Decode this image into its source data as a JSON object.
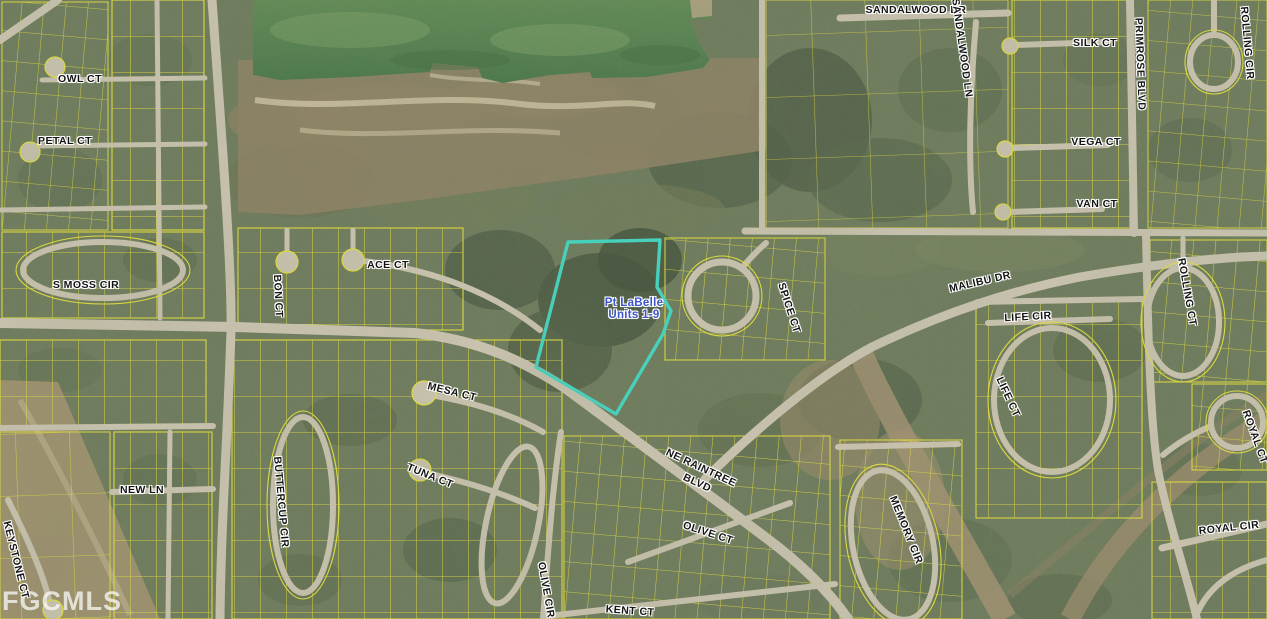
{
  "map": {
    "attribution": "FGCMLS",
    "highlight": {
      "line1": "Pt LaBelle",
      "line2": "Units 1-9",
      "outline_color": "#3fd9c6",
      "text_color": "#3d55cc"
    },
    "colors": {
      "parcel_line": "#e8e43c",
      "road": "#ccc5b2",
      "dirt": "#a29170",
      "water": "#54824f",
      "vegetation": "#5a684e"
    },
    "street_labels": [
      {
        "text": "OWL CT",
        "x": 80,
        "y": 79,
        "rot": 0
      },
      {
        "text": "PETAL CT",
        "x": 65,
        "y": 141,
        "rot": 0
      },
      {
        "text": "S MOSS CIR",
        "x": 86,
        "y": 285,
        "rot": 0
      },
      {
        "text": "SANDALWOOD DR",
        "x": 916,
        "y": 10,
        "rot": 0
      },
      {
        "text": "SANDALWOOD LN",
        "x": 962,
        "y": 48,
        "rot": 82
      },
      {
        "text": "SILK CT",
        "x": 1095,
        "y": 43,
        "rot": 0
      },
      {
        "text": "PRIMROSE BLVD",
        "x": 1140,
        "y": 64,
        "rot": 88
      },
      {
        "text": "ROLLING CIR",
        "x": 1247,
        "y": 43,
        "rot": 85
      },
      {
        "text": "VEGA CT",
        "x": 1096,
        "y": 142,
        "rot": 0
      },
      {
        "text": "VAN CT",
        "x": 1097,
        "y": 204,
        "rot": 0
      },
      {
        "text": "ACE CT",
        "x": 388,
        "y": 265,
        "rot": 0
      },
      {
        "text": "BON CT",
        "x": 278,
        "y": 296,
        "rot": 87
      },
      {
        "text": "SPICE CT",
        "x": 789,
        "y": 308,
        "rot": 72
      },
      {
        "text": "MALIBU DR",
        "x": 980,
        "y": 282,
        "rot": -13
      },
      {
        "text": "LIFE CIR",
        "x": 1028,
        "y": 317,
        "rot": -3
      },
      {
        "text": "ROLLING CT",
        "x": 1187,
        "y": 292,
        "rot": 80
      },
      {
        "text": "LIFE CT",
        "x": 1008,
        "y": 397,
        "rot": 65
      },
      {
        "text": "ROYAL CT",
        "x": 1255,
        "y": 437,
        "rot": 70
      },
      {
        "text": "MESA CT",
        "x": 452,
        "y": 392,
        "rot": 14
      },
      {
        "text": "NEW LN",
        "x": 142,
        "y": 490,
        "rot": 0
      },
      {
        "text": "KEYSTONE CT",
        "x": 16,
        "y": 560,
        "rot": 76
      },
      {
        "text": "BUTTERCUP CIR",
        "x": 281,
        "y": 502,
        "rot": 85
      },
      {
        "text": "TUNA CT",
        "x": 430,
        "y": 476,
        "rot": 22
      },
      {
        "text": "NE RAINTREE",
        "x": 701,
        "y": 468,
        "rot": 25
      },
      {
        "text": "BLVD",
        "x": 697,
        "y": 483,
        "rot": 25
      },
      {
        "text": "OLIVE CT",
        "x": 708,
        "y": 533,
        "rot": 18
      },
      {
        "text": "OLIVE CIR",
        "x": 546,
        "y": 590,
        "rot": 80
      },
      {
        "text": "KENT CT",
        "x": 630,
        "y": 611,
        "rot": 4
      },
      {
        "text": "MEMORY CIR",
        "x": 906,
        "y": 530,
        "rot": 68
      },
      {
        "text": "ROYAL CIR",
        "x": 1229,
        "y": 528,
        "rot": -6
      }
    ]
  }
}
